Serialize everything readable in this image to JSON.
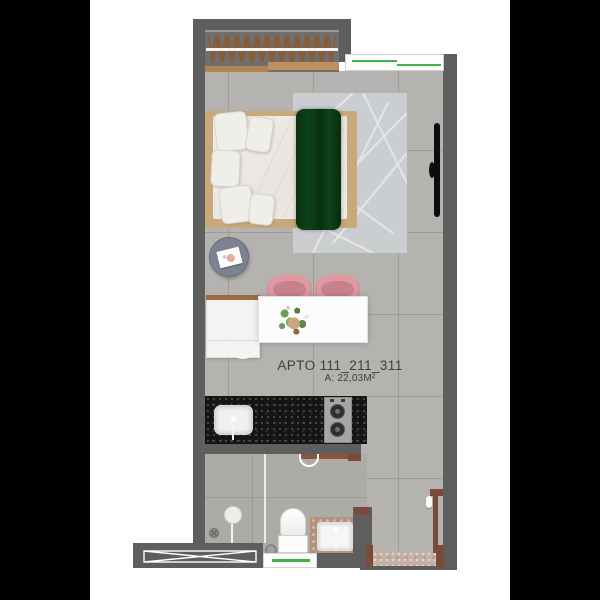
{
  "plan": {
    "apartment_label": "APTO 111_211_311",
    "area_label": "A: 22,03M²"
  },
  "colors": {
    "letterbox": "#000000",
    "background": "#ffffff",
    "wall": "#5e5e5e",
    "floor": "#b5b3b0",
    "bathroom_floor": "#adaba5",
    "glass_accent_green": "#3bb54a",
    "bed_throw_green": "#0c3a14",
    "chair_pink": "#dd9ba1",
    "wood_trim": "#9c6b45",
    "door_wood": "#7c4a39",
    "countertop_black": "#151515",
    "rug_gray": "#cbced1",
    "label_text": "#3e3e3e"
  },
  "elements": {
    "wardrobe": "wardrobe-with-hangers",
    "bed": "double-bed-with-green-throw",
    "rug": "geometric-rug",
    "tv": "wall-mounted-tv",
    "side_table": "round-side-table-with-book",
    "dining": "white-table-two-pink-chairs-plant",
    "cabinet": "white-kitchen-cabinet",
    "kitchen": "black-counter-sink-two-burner-cooktop",
    "bathroom": "shower-toilet-vanity-glass-partition",
    "window": "sliding-window-green-glass",
    "doors": "entry-door-and-bathroom-door",
    "shaft": "cross-hatched-service-shaft"
  }
}
